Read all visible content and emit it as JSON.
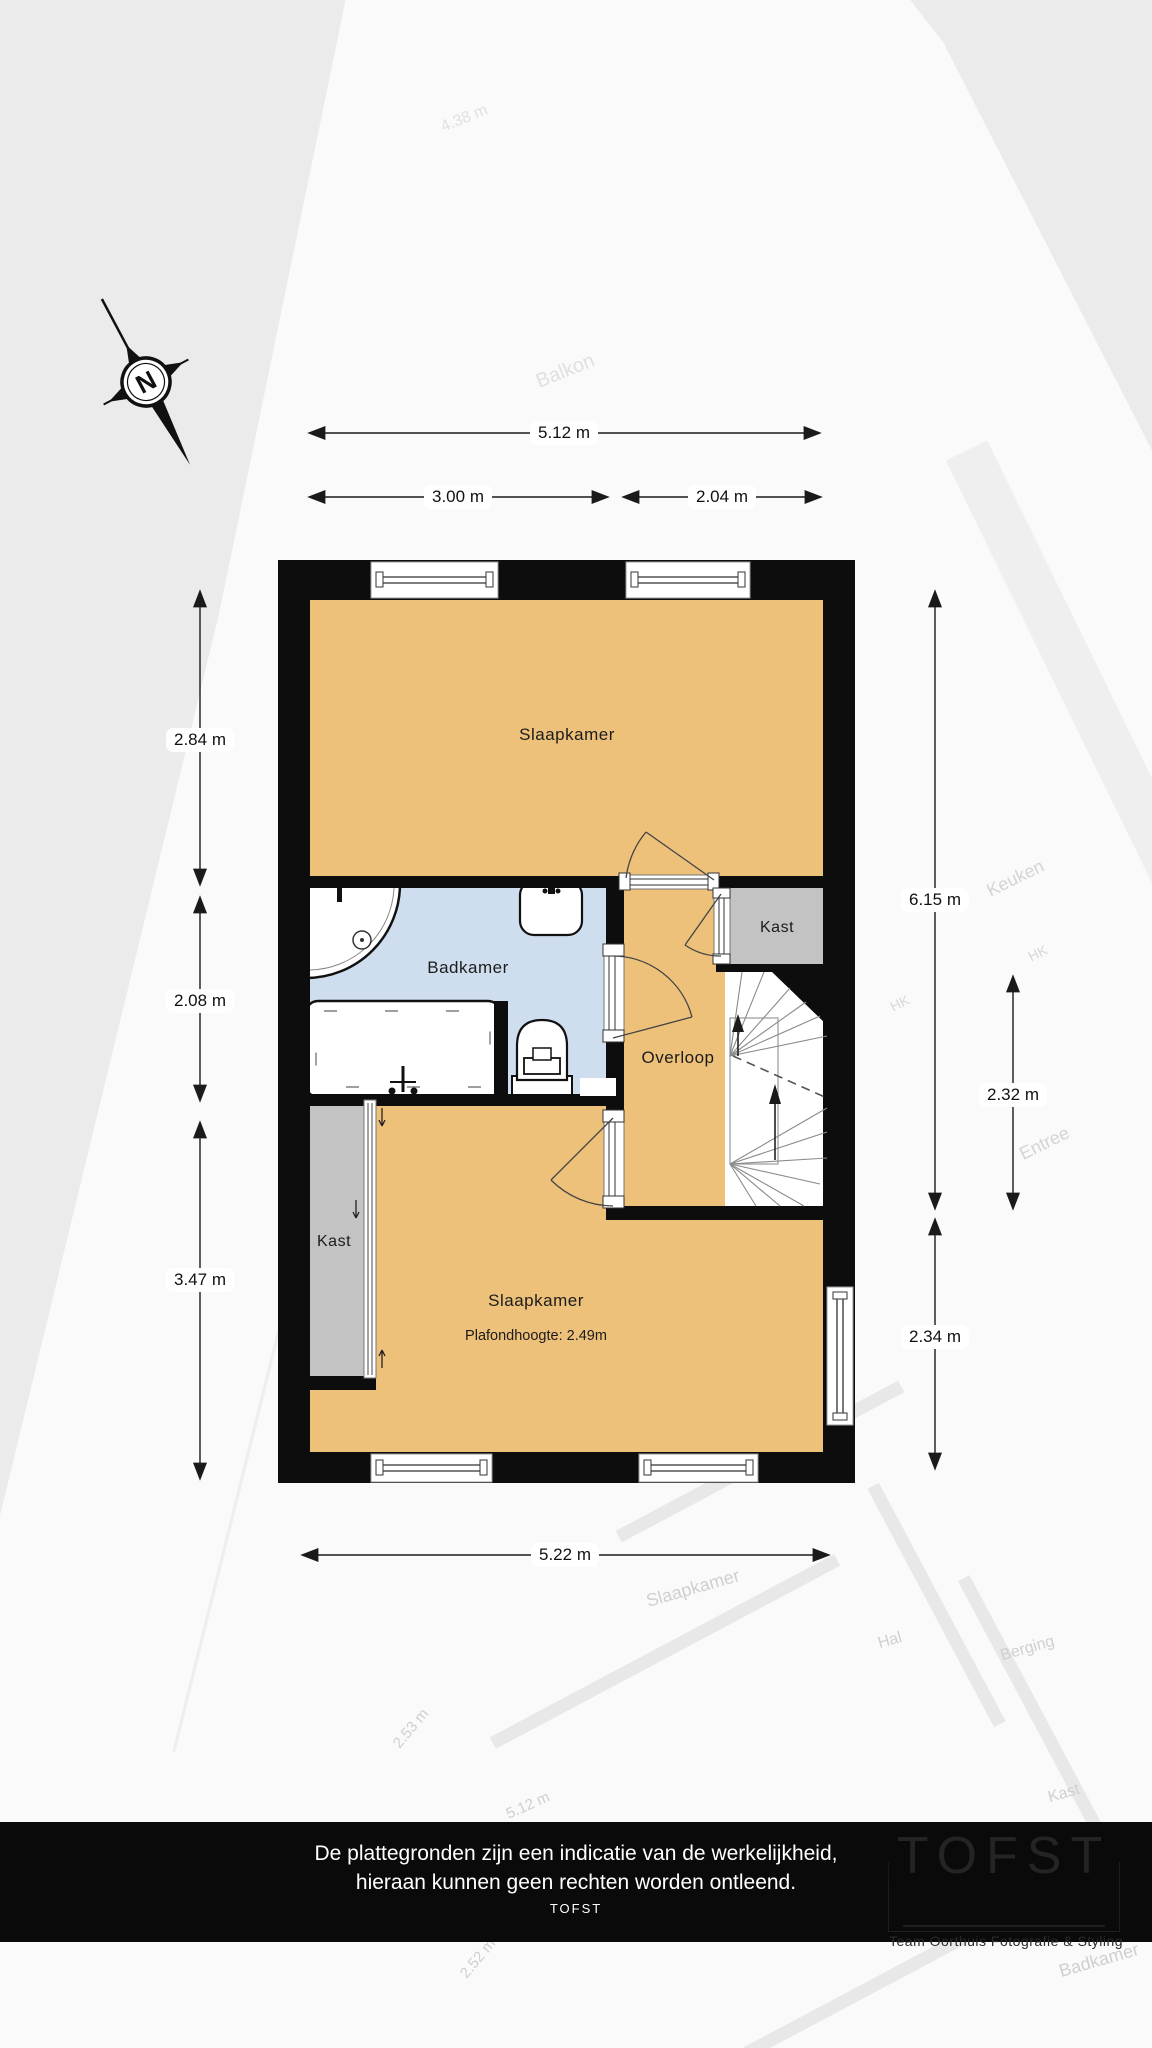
{
  "colors": {
    "room_orange": "#eec17b",
    "room_blue": "#cfdeee",
    "room_gray": "#c3c3c3",
    "wall_black": "#0d0d0d",
    "footer_bg": "#0a0a0a"
  },
  "compass": {
    "north": "N"
  },
  "dimensions": {
    "top_total": "5.12 m",
    "top_left": "3.00 m",
    "top_right": "2.04 m",
    "left_top": "2.84 m",
    "left_middle": "2.08 m",
    "left_bottom": "3.47 m",
    "right_total": "6.15 m",
    "right_middle": "2.32 m",
    "right_bottom": "2.34 m",
    "bottom_total": "5.22 m"
  },
  "rooms": {
    "slaapkamer_top": "Slaapkamer",
    "badkamer": "Badkamer",
    "kast_right": "Kast",
    "overloop": "Overloop",
    "kast_left": "Kast",
    "slaapkamer_bottom": "Slaapkamer",
    "slaapkamer_bottom_note": "Plafondhoogte: 2.49m"
  },
  "watermark_labels": [
    "4.38 m",
    "Balkon",
    "Keuken",
    "HK",
    "HK",
    "Entree",
    "Slaapkamer",
    "Hal",
    "Berging",
    "Kast",
    "2.53 m",
    "5.12 m",
    "2.52 m",
    "Badkamer"
  ],
  "footer": {
    "disclaimer_line1": "De plattegronden zijn een indicatie van de werkelijkheid,",
    "disclaimer_line2": "hieraan kunnen geen rechten worden ontleend.",
    "brand": "TOFST"
  },
  "logo": {
    "title": "TOFST",
    "subtitle": "Team Oorthuis Fotografie & Styling"
  }
}
